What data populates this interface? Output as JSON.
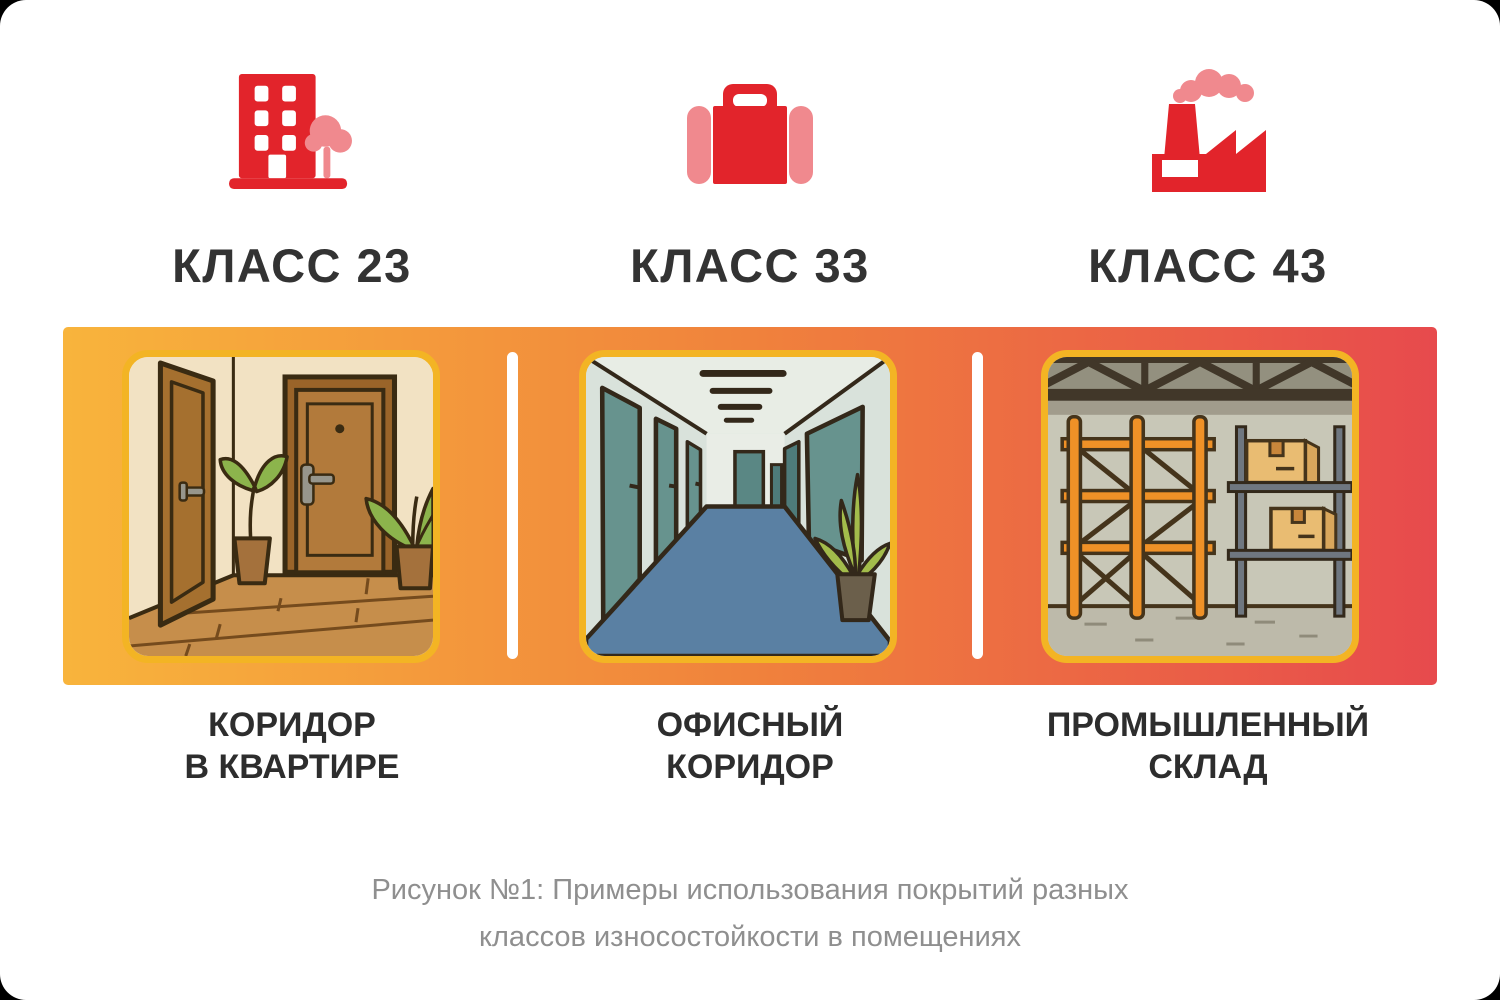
{
  "colors": {
    "card_background": "#FFFFFF",
    "icon_red": "#E2242B",
    "icon_pink": "#F0898E",
    "band_gradient_left": "#F8B43C",
    "band_gradient_middle": "#F0823C",
    "band_gradient_right": "#E74A4D",
    "image_border_gold": "#F3B424",
    "separator_white": "#FFFFFF",
    "heading_text": "#333333",
    "label_text": "#2D2D2D",
    "caption_text": "#8F8F8F"
  },
  "columns": [
    {
      "icon": "apartment-building-icon",
      "heading": "КЛАСС 23",
      "label_line1": "КОРИДОР",
      "label_line2": "В КВАРТИРЕ",
      "image": "apartment-corridor-illustration"
    },
    {
      "icon": "briefcase-icon",
      "heading": "КЛАСС 33",
      "label_line1": "ОФИСНЫЙ",
      "label_line2": "КОРИДОР",
      "image": "office-corridor-illustration"
    },
    {
      "icon": "factory-icon",
      "heading": "КЛАСС 43",
      "label_line1": "ПРОМЫШЛЕННЫЙ",
      "label_line2": "СКЛАД",
      "image": "industrial-warehouse-illustration"
    }
  ],
  "caption": {
    "line1": "Рисунок №1: Примеры использования покрытий разных",
    "line2": "классов износостойкости в помещениях"
  }
}
